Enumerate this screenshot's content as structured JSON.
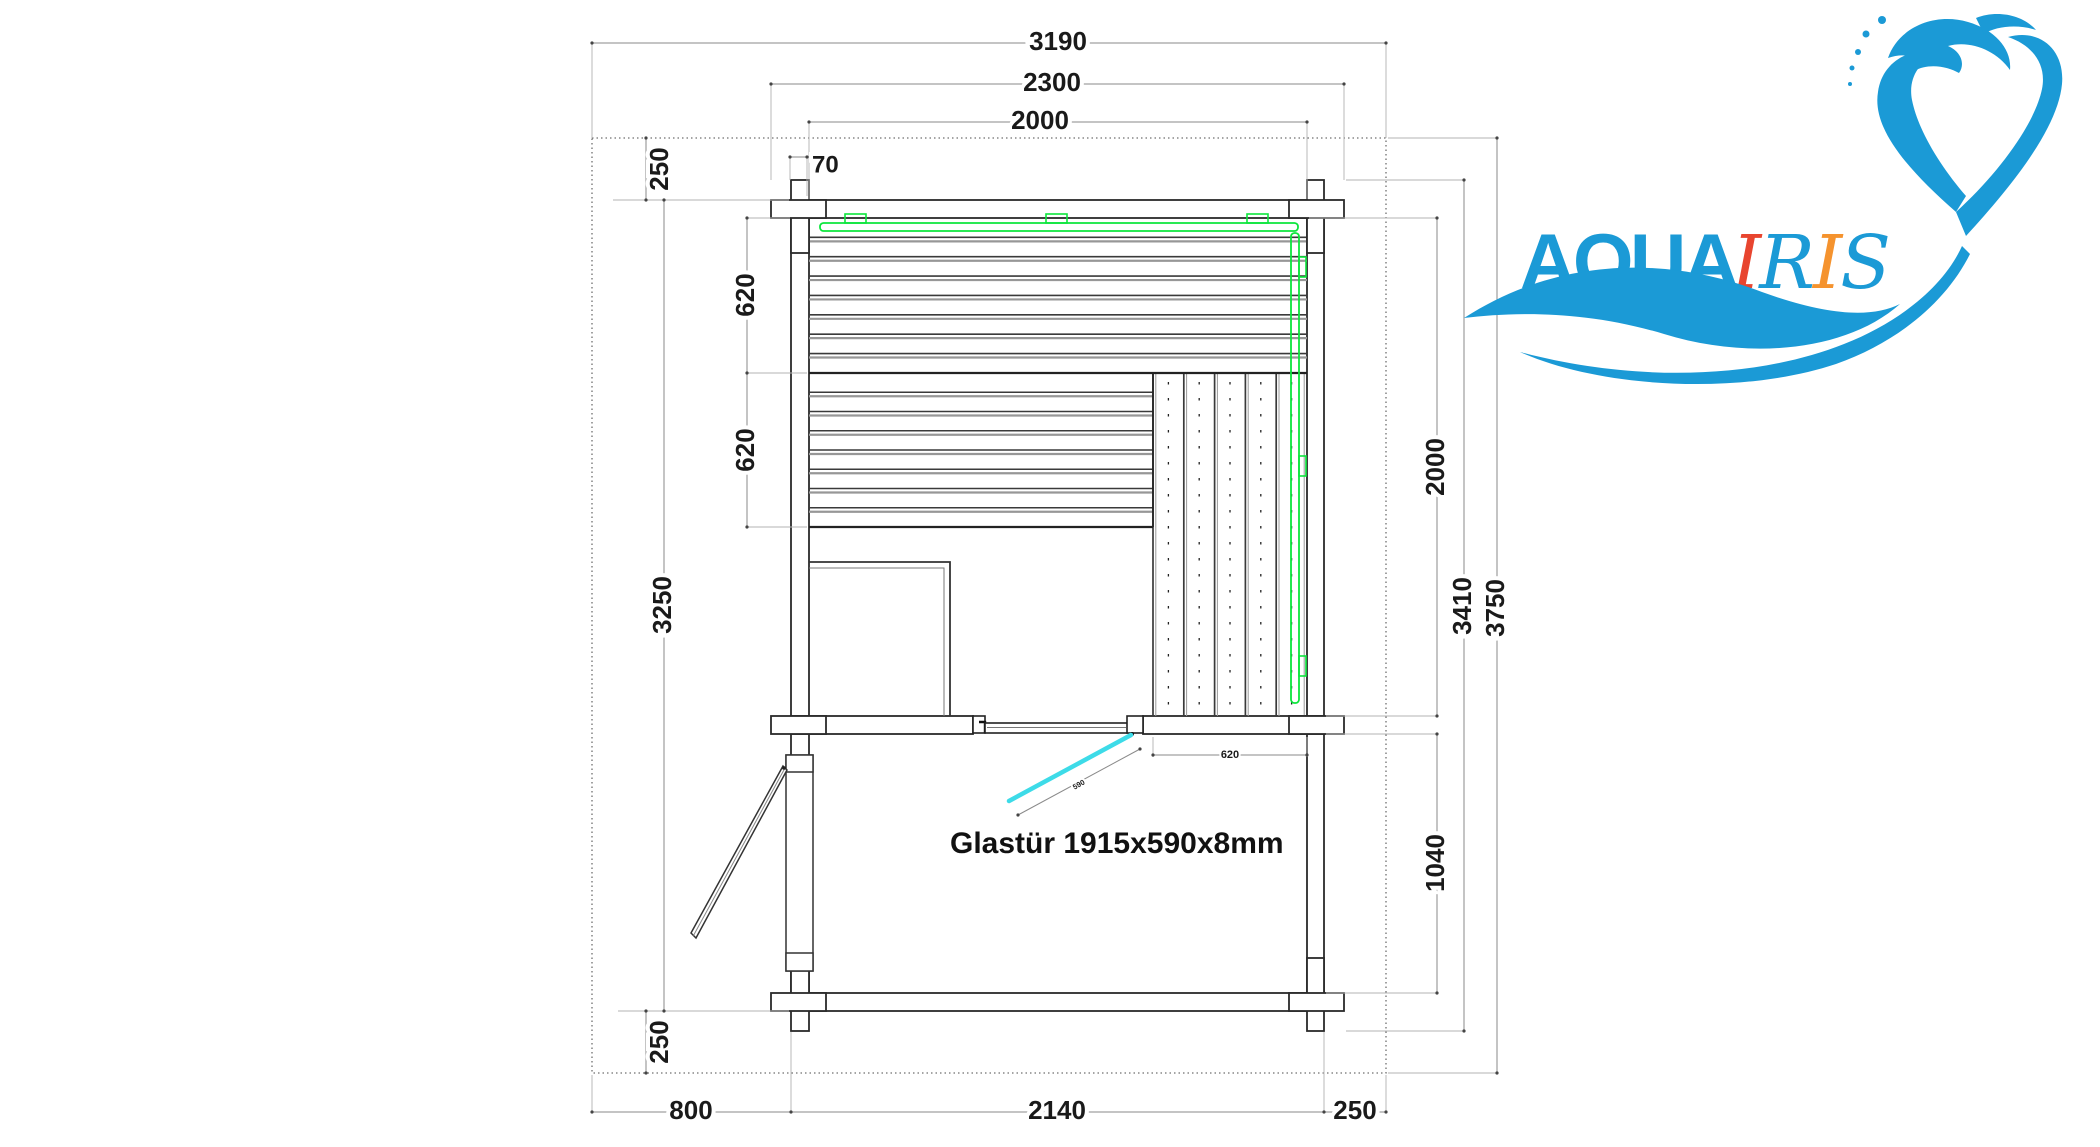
{
  "drawing": {
    "glass_door_label": "Glastür 1915x590x8mm",
    "glass_door_width": "590"
  },
  "dims": {
    "top": {
      "total_width": "3190",
      "log_span_width": "2300",
      "interior_width": "2000"
    },
    "left": {
      "overhang_top": "250",
      "wall_thickness": "70",
      "bench_depth_upper": "620",
      "bench_depth_lower": "620",
      "building_depth": "3250",
      "overhang_bottom": "250"
    },
    "right": {
      "sauna_interior_depth": "2000",
      "side_bench_width": "620",
      "front_room_depth": "1040",
      "log_span_depth": "3410",
      "total_depth": "3750"
    },
    "bottom": {
      "left_offset": "800",
      "building_width": "2140",
      "right_offset": "250"
    }
  },
  "logo": {
    "word_aqua": "AQUA",
    "word_iris": [
      {
        "ch": "I",
        "color": "#e8452f"
      },
      {
        "ch": "R",
        "color": "#1b9ad6"
      },
      {
        "ch": "I",
        "color": "#f5932e"
      },
      {
        "ch": "S",
        "color": "#1b9ad6"
      }
    ],
    "brand_blue": "#1b9ad6"
  },
  "colors": {
    "led_green": "#0ce63c",
    "glass_cyan": "#3ddbe8",
    "line_dark": "#2a2a2a",
    "dim_line": "#8a8a8a",
    "label": "#1a1a1a"
  }
}
